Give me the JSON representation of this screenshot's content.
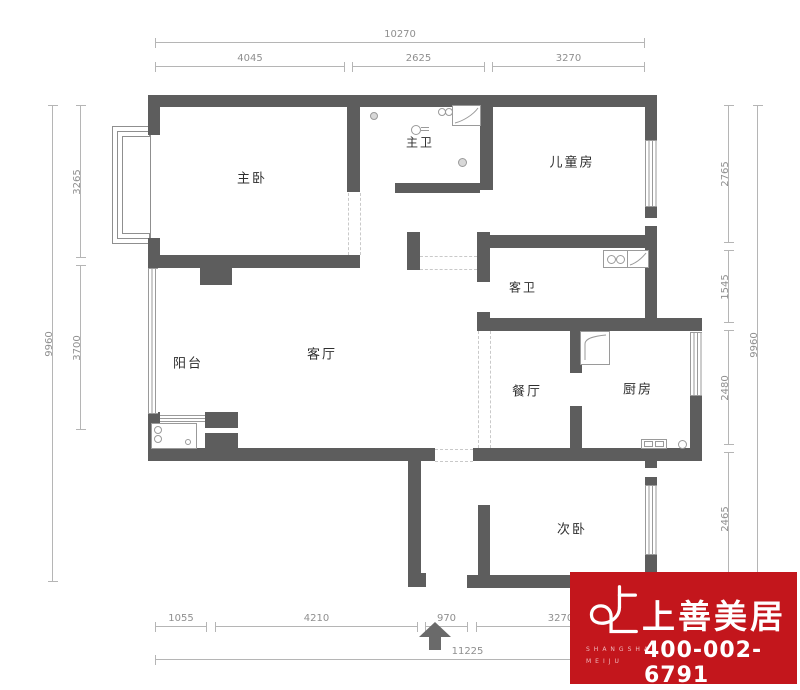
{
  "dimensions": {
    "top": {
      "total": "10270",
      "seg1": "4045",
      "seg2": "2625",
      "seg3": "3270"
    },
    "left": {
      "total": "9960",
      "seg1": "3265",
      "seg2": "3700"
    },
    "right": {
      "total": "9960",
      "seg1": "2765",
      "seg2": "1545",
      "seg3": "2480",
      "seg4": "2465"
    },
    "bottom": {
      "total": "11225",
      "seg1": "1055",
      "seg2": "4210",
      "seg3": "970",
      "seg4": "3270"
    }
  },
  "rooms": {
    "master_bedroom": "主卧",
    "master_bath": "主卫",
    "kids_room": "儿童房",
    "guest_bath": "客卫",
    "living_room": "客厅",
    "balcony": "阳台",
    "dining_room": "餐厅",
    "kitchen": "厨房",
    "second_bedroom": "次卧"
  },
  "logo": {
    "brand": "上善美居",
    "latin1": "SHANGSHAN",
    "latin2": "MEIJU",
    "phone": "400-002-6791",
    "bg_color": "#c3161c",
    "text_color": "#ffffff"
  },
  "colors": {
    "wall": "#5d5d5d",
    "dimension_line": "#b5b5b5",
    "dimension_text": "#8f8f8f",
    "label_text": "#2f2f2f"
  }
}
